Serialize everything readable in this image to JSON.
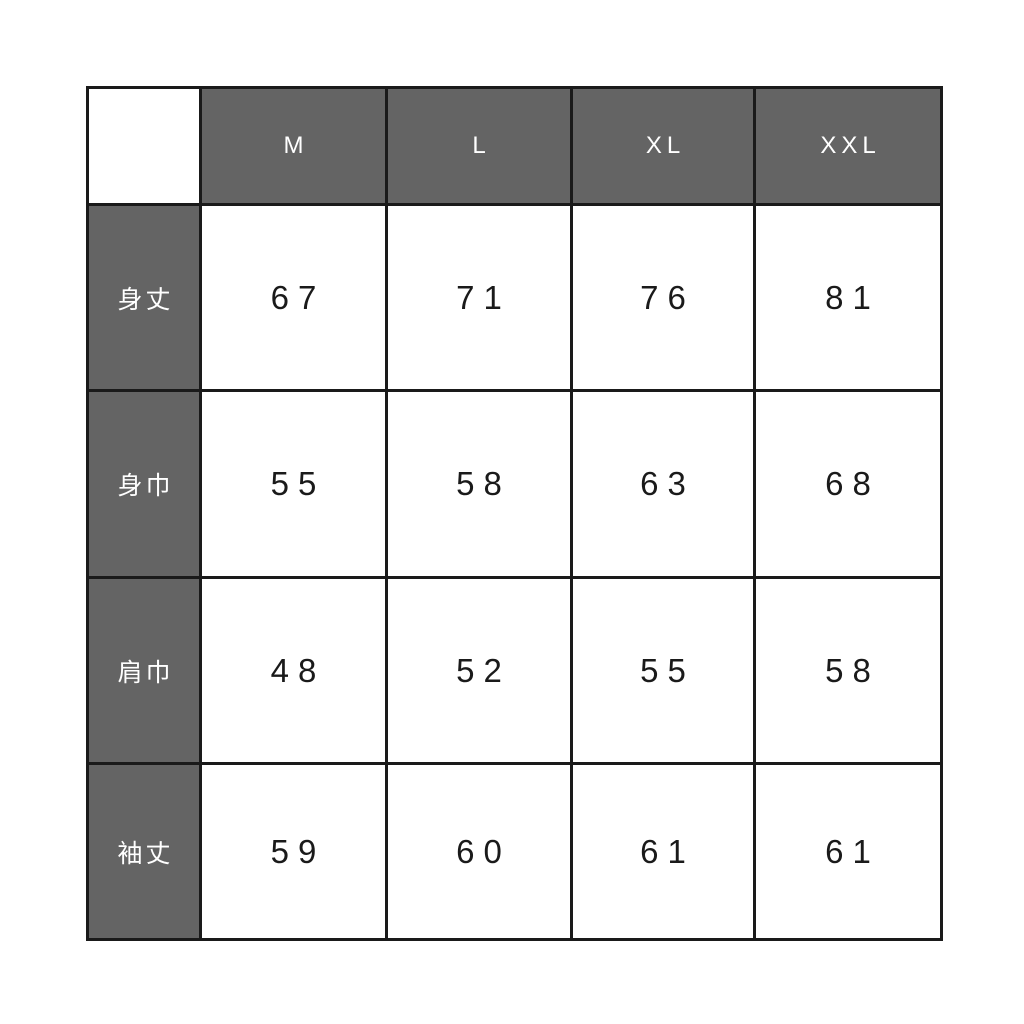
{
  "colors": {
    "header_bg": "#646464",
    "header_text": "#ffffff",
    "cell_bg": "#ffffff",
    "cell_text": "#1a1a1a",
    "border": "#1a1a1a",
    "page_bg": "#ffffff"
  },
  "size_chart": {
    "column_headers": [
      "M",
      "L",
      "XL",
      "XXL"
    ],
    "rows": [
      {
        "label": "身丈",
        "values": [
          "67",
          "71",
          "76",
          "81"
        ]
      },
      {
        "label": "身巾",
        "values": [
          "55",
          "58",
          "63",
          "68"
        ]
      },
      {
        "label": "肩巾",
        "values": [
          "48",
          "52",
          "55",
          "58"
        ]
      },
      {
        "label": "袖丈",
        "values": [
          "59",
          "60",
          "61",
          "61"
        ]
      }
    ]
  },
  "chart_data": {
    "type": "table",
    "columns": [
      "",
      "M",
      "L",
      "XL",
      "XXL"
    ],
    "row_labels": [
      "身丈",
      "身巾",
      "肩巾",
      "袖丈"
    ],
    "rows": [
      [
        "身丈",
        67,
        71,
        76,
        81
      ],
      [
        "身巾",
        55,
        58,
        63,
        68
      ],
      [
        "肩巾",
        48,
        52,
        55,
        58
      ],
      [
        "袖丈",
        59,
        60,
        61,
        61
      ]
    ],
    "title": "",
    "legend": "none",
    "grid": "full-borders"
  }
}
